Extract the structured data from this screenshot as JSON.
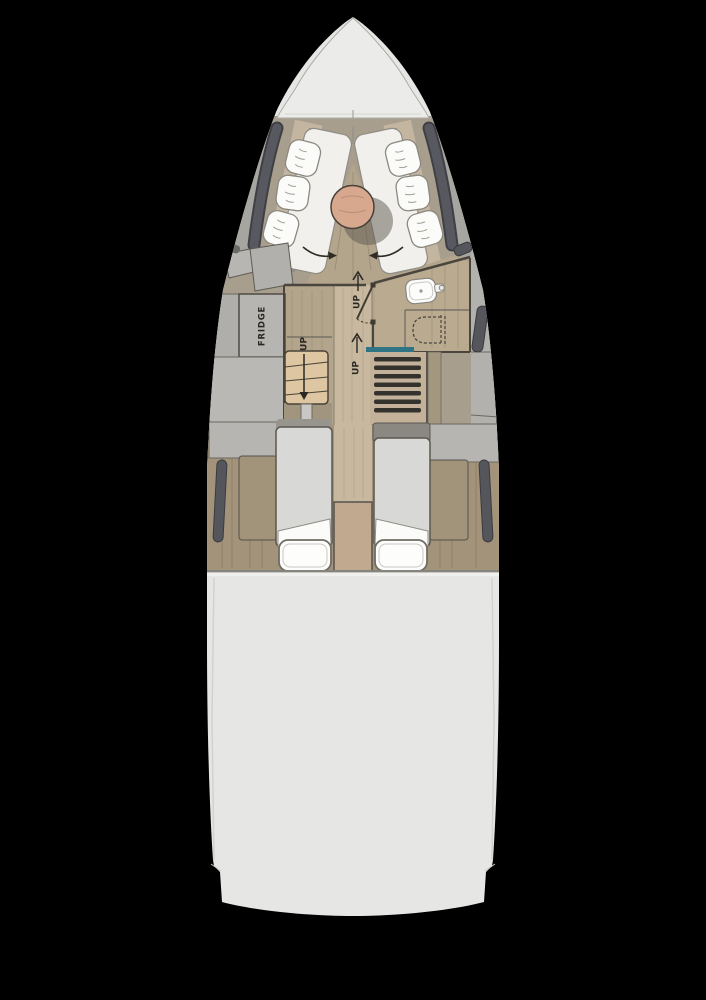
{
  "plan": {
    "type": "yacht-interior-floor-plan",
    "background": "#000000",
    "labels": {
      "fridge": "FRIDGE",
      "up_forward": "UP",
      "up_mid": "UP",
      "up_companionway": "UP"
    },
    "colors": {
      "hull": "#e6e6e4",
      "bow_deck": "#ebebe9",
      "cabin_wall": "#a89e8e",
      "wood_floor": "#b3a48c",
      "wood_dark": "#a2937b",
      "wood_light": "#c7b89f",
      "bathroom_floor": "#b9aa90",
      "hull_window": "#55565b",
      "seat_cushion": "#f1f0ed",
      "backrest": "#c3b5a0",
      "pillow": "#fbfbf9",
      "table_top": "#d8a88e",
      "cabinet": "#b6b5b1",
      "steps": "#ddc6a1",
      "stair_tread": "#34322d",
      "stair_accent": "#2e7484",
      "mattress": "#d8d8d6",
      "bed_header": "#8a8880",
      "duvet": "#fdfdfc",
      "tan_panel": "#c0a98e",
      "ink": "#2b2823"
    },
    "fixtures": [
      "bow-deck",
      "v-berth-lounge",
      "seat-cushions",
      "pillows",
      "dining-table",
      "fridge",
      "companionway-steps",
      "bathroom",
      "sink",
      "toilet",
      "staircase",
      "twin-beds",
      "hull-windows",
      "stern-deck"
    ]
  }
}
